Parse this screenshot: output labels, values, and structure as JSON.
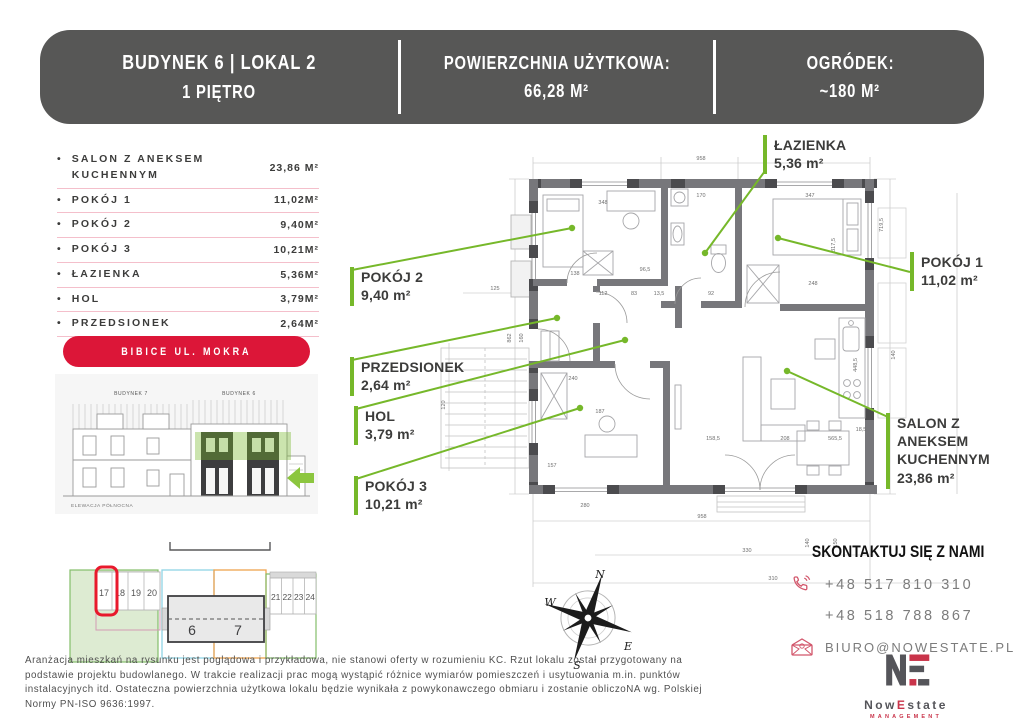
{
  "header": {
    "building": "BUDYNEK 6 | LOKAL 2",
    "floor": "1 PIĘTRO",
    "area_label": "POWIERZCHNIA UŻYTKOWA:",
    "area_value": "66,28 M²",
    "garden_label": "OGRÓDEK:",
    "garden_value": "~180 M²"
  },
  "room_list": [
    {
      "name": "SALON Z ANEKSEM KUCHENNYM",
      "value": "23,86 M²"
    },
    {
      "name": "POKÓJ 1",
      "value": "11,02M²"
    },
    {
      "name": "POKÓJ 2",
      "value": "9,40M²"
    },
    {
      "name": "POKÓJ 3",
      "value": "10,21M²"
    },
    {
      "name": "ŁAZIENKA",
      "value": "5,36M²"
    },
    {
      "name": "HOL",
      "value": "3,79M²"
    },
    {
      "name": "PRZEDSIONEK",
      "value": "2,64M²"
    }
  ],
  "misc": {
    "bullet": "•"
  },
  "location_button": "BIBICE UL. MOKRA",
  "elevation": {
    "left_label": "BUDYNEK 7",
    "right_label": "BUDYNEK 6",
    "caption": "ELEWACJA PÓŁNOCNA"
  },
  "site_plan": {
    "spots_left": [
      "17",
      "18",
      "19",
      "20"
    ],
    "spots_right": [
      "21",
      "22",
      "23",
      "24"
    ],
    "building_left": "6",
    "building_right": "7"
  },
  "plan": {
    "labels": [
      {
        "name": "ŁAZIENKA",
        "area": "5,36 m²"
      },
      {
        "name": "POKÓJ 1",
        "area": "11,02 m²"
      },
      {
        "name": "POKÓJ 2",
        "area": "9,40 m²"
      },
      {
        "name": "PRZEDSIONEK",
        "area": "2,64 m²"
      },
      {
        "name": "HOL",
        "area": "3,79 m²"
      },
      {
        "name": "POKÓJ 3",
        "area": "10,21 m²"
      },
      {
        "name": "SALON Z ANEKSEM KUCHENNYM",
        "area": "23,86 m²"
      }
    ],
    "dims": {
      "d958t": "958",
      "d958b": "958",
      "d862": "862",
      "d160": "160",
      "d125": "125",
      "d120": "120",
      "d280": "280",
      "d348": "348",
      "d170": "170",
      "d347": "347",
      "d138": "138",
      "d96": "96,5",
      "d112": "112",
      "d83": "83",
      "d135": "13,5",
      "d92": "92",
      "d248": "248",
      "d719": "719,5",
      "d317": "317,5",
      "d140r": "140",
      "d448": "448,5",
      "d240": "240",
      "d187": "187",
      "d157": "157",
      "d158": "158,5",
      "d208": "208",
      "d565": "565,5",
      "d185": "18,5",
      "d330": "330",
      "d310": "310",
      "d140b": "140",
      "d150": "150"
    }
  },
  "compass": {
    "n": "N",
    "e": "E",
    "s": "S",
    "w": "W"
  },
  "contact": {
    "title": "SKONTAKTUJ SIĘ Z NAMI",
    "phone1": "+48 517 810 310",
    "phone2": "+48 518 788 867",
    "email": "BIURO@NOWESTATE.PL"
  },
  "logo": {
    "now": "Now",
    "e": "E",
    "state": "state",
    "sub": "MANAGEMENT"
  },
  "disclaimer": "Aranżacja mieszkań na rysunku jest poglądowa i przykładowa, nie stanowi oferty w rozumieniu KC. Rzut lokalu został przygotowany na podstawie projektu budowlanego. W trakcie realizacji prac mogą wystąpić różnice wymiarów pomieszczeń i usytuowania m.in. punktów instalacyjnych itd. Ostateczna powierzchnia użytkowa lokalu będzie wynikała z powykonawczego obmiaru i zostanie obliczoNA wg. Polskiej Normy PN-ISO 9636:1997.",
  "colors": {
    "accent_green": "#76B82A",
    "accent_red": "#DC1638",
    "header_gray": "#575756"
  }
}
